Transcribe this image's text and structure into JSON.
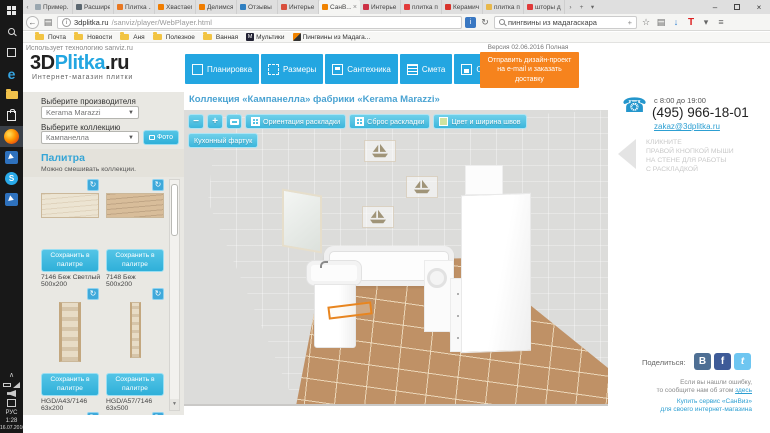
{
  "taskbar": {
    "icons": [
      {
        "name": "start"
      },
      {
        "name": "search"
      },
      {
        "name": "task-view"
      },
      {
        "name": "edge"
      },
      {
        "name": "file-explorer"
      },
      {
        "name": "store"
      },
      {
        "name": "firefox",
        "active": true
      },
      {
        "name": "remote-app"
      },
      {
        "name": "skype",
        "glyph": "S"
      },
      {
        "name": "remote-app-2"
      }
    ],
    "tray": {
      "hidden_icons": "∧",
      "lang": "РУС",
      "time": "1:28",
      "date": "16.07.2016"
    }
  },
  "browser": {
    "tabs": [
      {
        "label": "Пример...",
        "fav": "#9aa7b0"
      },
      {
        "label": "Расшире...",
        "fav": "#5b6770"
      },
      {
        "label": "Плитка ...",
        "fav": "#e87722"
      },
      {
        "label": "Хвастаем...",
        "fav": "#f07d00"
      },
      {
        "label": "Делимся...",
        "fav": "#f07d00"
      },
      {
        "label": "Отзывы ...",
        "fav": "#2f7fc1"
      },
      {
        "label": "Интерье...",
        "fav": "#d94f3d"
      },
      {
        "label": "СанВ...",
        "fav": "#f08300",
        "active": true
      },
      {
        "label": "Интерье...",
        "fav": "#cc2f44"
      },
      {
        "label": "плитка п...",
        "fav": "#e23b3b"
      },
      {
        "label": "Керамич...",
        "fav": "#d8342c"
      },
      {
        "label": "плитка п...",
        "fav": "#e8b84b"
      },
      {
        "label": "шторы д...",
        "fav": "#e03a3a"
      }
    ],
    "close_glyph": "×",
    "tab_scroll_left": "‹",
    "tab_overflow": "›",
    "new_tab": "+",
    "tab_dropdown": "▾",
    "window_controls": {
      "minimize": "–",
      "close": "×"
    },
    "nav": {
      "back": "←",
      "info": "i",
      "refresh": "↻",
      "star": "☆",
      "library": "▤",
      "download": "↓",
      "t_addon": "T",
      "dropdown": "▾",
      "menu": "≡",
      "page_action": "i"
    },
    "url": {
      "host": "3dplitka.ru",
      "path": "/sanviz/player/WebPlayer.html"
    },
    "search": {
      "value": "пингвины из мадагаскара",
      "plus": "+"
    },
    "bookmarks": [
      {
        "label": "Почта",
        "icon": "folder"
      },
      {
        "label": "Новости",
        "icon": "folder"
      },
      {
        "label": "Аня",
        "icon": "folder"
      },
      {
        "label": "Полезное",
        "icon": "folder"
      },
      {
        "label": "Ванная",
        "icon": "folder"
      },
      {
        "label": "Мультики",
        "icon": "m-badge",
        "badge": "M"
      },
      {
        "label": "Пингвины из Мадага...",
        "icon": "penguin"
      }
    ]
  },
  "site": {
    "tech_note": "Использует технологию sanviz.ru",
    "logo": {
      "p1": "3D",
      "p2": "Plitka",
      "p3": ".ru",
      "subtitle": "Интернет-магазин плитки"
    },
    "nav": [
      {
        "label": "Планировка"
      },
      {
        "label": "Размеры"
      },
      {
        "label": "Сантехника"
      },
      {
        "label": "Смета"
      },
      {
        "label": "Сохранить"
      }
    ],
    "send_button": "Отправить дизайн-проект на e-mail и заказать доставку",
    "version": "Версия 02.06.2016 Полная"
  },
  "sidebar": {
    "manufacturer_label": "Выберите производителя",
    "manufacturer_value": "Kerama Marazzi",
    "collection_label": "Выберите коллекцию",
    "collection_value": "Кампанелла",
    "select_arrow": "▼",
    "photo_button": "Фото",
    "palette_title": "Палитра",
    "palette_note": "Можно смешивать коллекции.",
    "save_button": "Сохранить в палитре",
    "rotate_glyph": "↻",
    "scroll_down_glyph": "▼",
    "items": [
      {
        "code": "7146  Беж Светлый",
        "size": "500x200"
      },
      {
        "code": "7148  Беж",
        "size": "500x200"
      },
      {
        "code": "HGD/A43/7146",
        "size": "63x200"
      },
      {
        "code": "HGD/A57/7146",
        "size": "63x500"
      }
    ]
  },
  "main": {
    "title": "Коллекция «Кампанелла» фабрики «Kerama Marazzi»",
    "toolbar": {
      "zoom_out": "−",
      "zoom_in": "+",
      "orientation": "Ориентация раскладки",
      "reset": "Сброс раскладки",
      "seams": "Цвет и ширина швов",
      "apron": "Кухонный фартук"
    }
  },
  "contact": {
    "hours": "с 8:00 до 19:00",
    "phone": "(495) 966-18-01",
    "email": "zakaz@3dplitka.ru",
    "hint_lines": [
      "КЛИКНИТЕ",
      "ПРАВОЙ КНОПКОЙ МЫШИ",
      "НА СТЕНЕ ДЛЯ РАБОТЫ",
      "С РАСКЛАДКОЙ"
    ]
  },
  "footer": {
    "share_label": "Поделиться:",
    "share": [
      {
        "name": "vk",
        "glyph": "В"
      },
      {
        "name": "facebook",
        "glyph": "f"
      },
      {
        "name": "twitter",
        "glyph": "t"
      }
    ],
    "error_lines": [
      "Если вы нашли ошибку,",
      "то сообщите нам об этом "
    ],
    "error_link": "здесь",
    "buy_lines": [
      "Купить сервис «СанВиз»",
      "для своего интернет-магазина"
    ]
  },
  "colors": {
    "accent_blue": "#23a6e1",
    "accent_cyan": "#3cb6dc",
    "accent_orange": "#f6831d",
    "link_blue": "#2d9fd2"
  }
}
